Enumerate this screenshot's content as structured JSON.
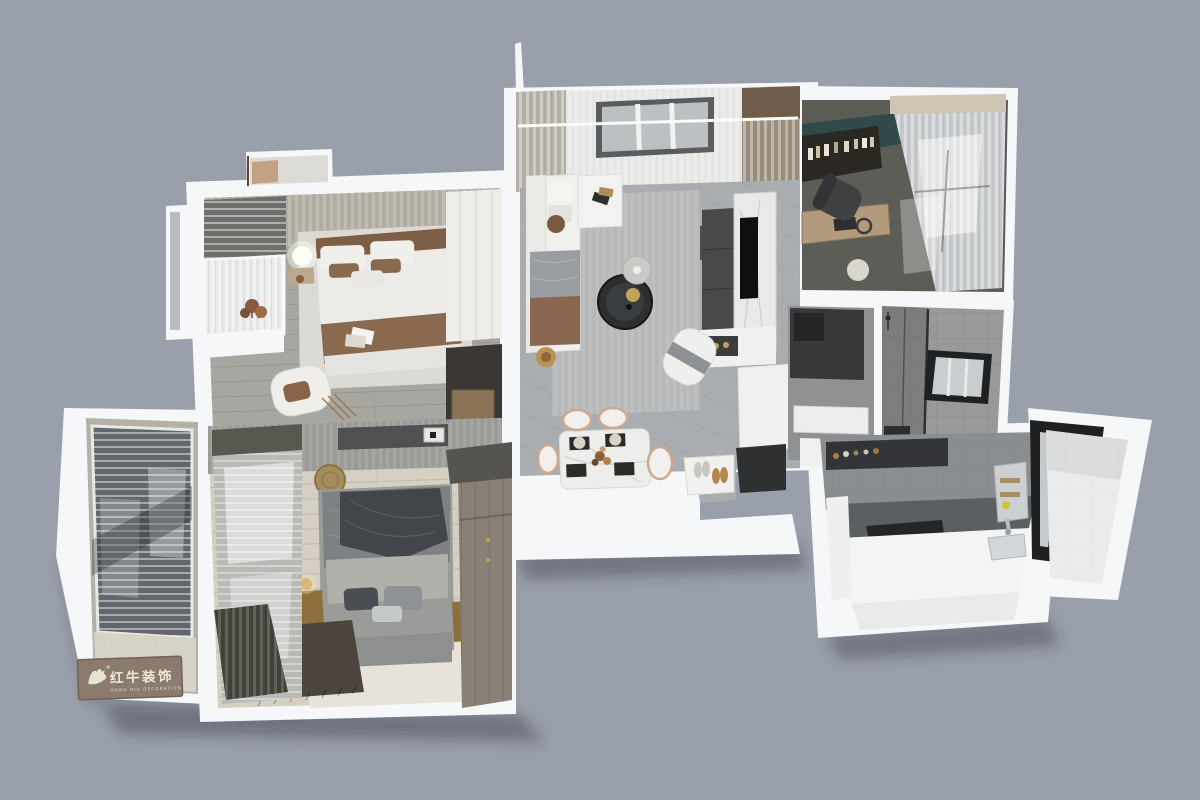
{
  "watermark": {
    "brand_cn": "红牛装饰",
    "brand_en": "HONG NIU DECORATION",
    "registered_mark": "®"
  },
  "palette": {
    "bg": "#9aa0ab",
    "wall": "#f6f7f8",
    "wallShade": "#e9ebec",
    "floorTile": "#a9adb0",
    "floorWoodGray": "#a7a6a1",
    "floorWoodWarm": "#d6d0c3",
    "rugLight": "#b7b9ba",
    "rugDark": "#4b453d",
    "sofaWhite": "#f0f0ed",
    "accentTeal": "#30494a",
    "accentBrown": "#8a6a4e",
    "bedGray": "#9a9c9a",
    "duvetGray": "#7e8183",
    "blanketDark": "#42464a",
    "darkUnit": "#303234",
    "marble": "#e9e9e9",
    "gold": "#c2a15c",
    "woodDesk": "#b39a7c",
    "woodWardrobe": "#8a8176",
    "tileWall": "#97999b",
    "counter": "#f3f4f4",
    "glass": "#c6cacc",
    "windowBlack": "#1e2022",
    "plaque": "#8b7b6d",
    "plaqueText": "#f0ead9"
  },
  "scene": {
    "view": "3D dollhouse floor-plan render of an apartment",
    "rooms": [
      "left-balcony",
      "master-bedroom",
      "second-bedroom",
      "living-room",
      "dining-area",
      "entry",
      "study",
      "closet-hall",
      "bathroom",
      "kitchen",
      "utility-balcony"
    ]
  }
}
